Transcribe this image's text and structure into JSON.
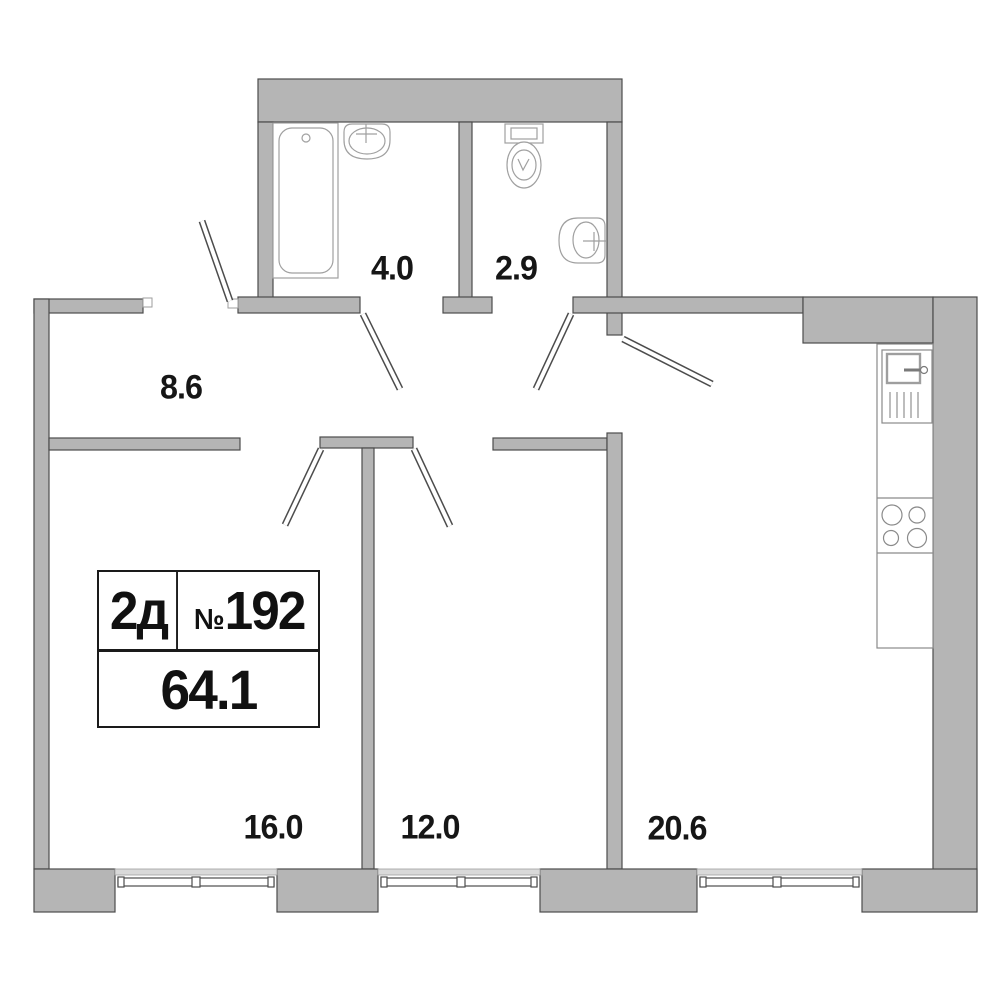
{
  "floorplan": {
    "info_box": {
      "unit_type": "2д",
      "number_sign": "№",
      "unit_number": "192",
      "total_area": "64.1"
    },
    "rooms": [
      {
        "name": "bathroom",
        "area": "4.0"
      },
      {
        "name": "toilet",
        "area": "2.9"
      },
      {
        "name": "hallway",
        "area": "8.6"
      },
      {
        "name": "bedroom-1",
        "area": "16.0"
      },
      {
        "name": "bedroom-2",
        "area": "12.0"
      },
      {
        "name": "kitchen-living-room",
        "area": "20.6"
      }
    ],
    "fixtures": [
      "bathtub-icon",
      "bathroom-sink-icon",
      "toilet-icon",
      "toilet-sink-icon",
      "kitchen-sink-icon",
      "stove-icon"
    ],
    "colors": {
      "wall_fill": "#b5b5b5",
      "wall_outline": "#4c4c4c",
      "fixture_line": "#a0a0a0",
      "window_sill": "#d9d9d9",
      "text": "#161616",
      "background": "#ffffff"
    }
  }
}
